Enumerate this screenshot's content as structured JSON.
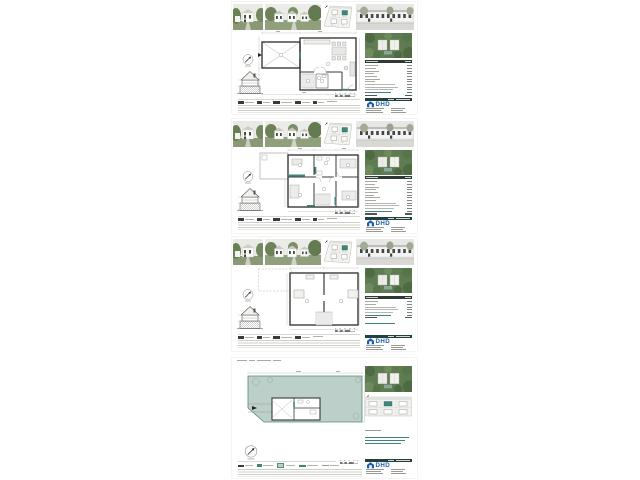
{
  "branding": {
    "logo_text": "DHD",
    "logo_blue": "#1b5faa",
    "logo_header_bar": "#24403c"
  },
  "palette": {
    "accent_teal": "#3f8578",
    "plot_fill": "#bccfc9",
    "wall_color": "#3a3a3a",
    "vegetation_green": "#678153",
    "paper": "#ffffff",
    "table_header": "#2c3a33"
  },
  "sheets": [
    {
      "id": "sheet-1",
      "content": "floor-plan-with-garage",
      "area_table_rows": 12,
      "has_highlight_row": true
    },
    {
      "id": "sheet-2",
      "content": "upper-floor-plan",
      "area_table_rows": 13,
      "has_highlight_row": true
    },
    {
      "id": "sheet-3",
      "content": "attic-floor-plan",
      "area_table_rows": 7,
      "has_highlight_row": true
    },
    {
      "id": "sheet-4",
      "content": "site-plan",
      "area_table_rows": 0,
      "has_highlight_row": false
    }
  ]
}
